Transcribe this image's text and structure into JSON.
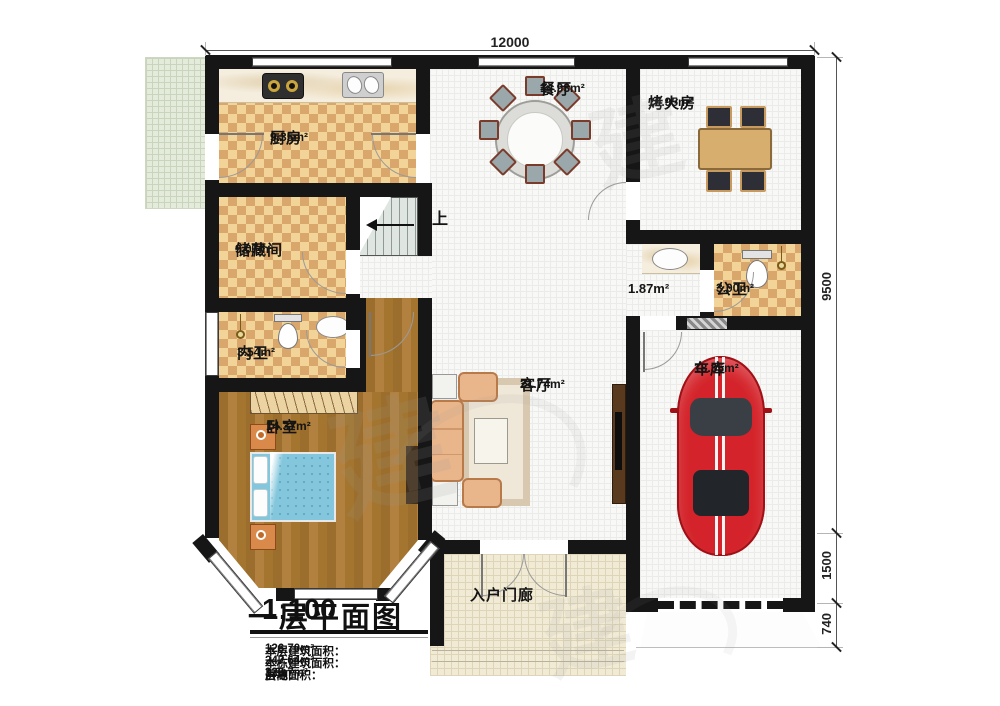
{
  "plan": {
    "dim_top": "12000",
    "dim_right_main": "9500",
    "dim_right_mid": "1500",
    "dim_right_small": "740"
  },
  "rooms": {
    "kitchen": {
      "name": "厨房",
      "area": "9.35m²"
    },
    "dining": {
      "name": "餐厅",
      "area": "14.93m²"
    },
    "fire_room": {
      "name": "烤火房",
      "area": "10.95m²"
    },
    "storage": {
      "name": "储藏间",
      "area": "9.07m²"
    },
    "hallway": {
      "area": "1.87m²"
    },
    "public_bath": {
      "name": "公卫",
      "area": "3.00m²"
    },
    "inner_bath": {
      "name": "内卫",
      "area": "3.54m²"
    },
    "bedroom": {
      "name": "卧室",
      "area": "14.37m²"
    },
    "living": {
      "name": "客厅",
      "area": "21.74m²"
    },
    "garage": {
      "name": "车库",
      "area": "18.35m²"
    },
    "porch": {
      "name": "入户门廊"
    }
  },
  "stairs": {
    "up": "上"
  },
  "title_block": {
    "title": "一层平面图",
    "scale": "1:100",
    "lines": [
      {
        "label": "本层建筑面积：",
        "value": "126.70m²"
      },
      {
        "label": "本栋建筑面积：",
        "value": "247.64m²"
      },
      {
        "label": "占地面积：",
        "value": "126.7m²",
        "label2": "层高：",
        "value2": "3.6m"
      }
    ]
  },
  "watermark": {
    "glyph": "建"
  }
}
